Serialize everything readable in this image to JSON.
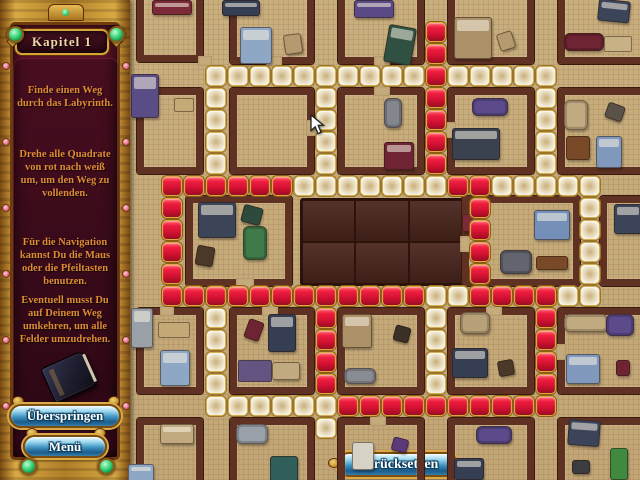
{
  "window": {
    "width": 640,
    "height": 480
  },
  "sidebar": {
    "title": "Kapitel 1",
    "paragraphs": [
      "Finde einen Weg durch das Labyrinth.",
      "Drehe alle Quadrate von rot nach weiß um, um den Weg zu vollenden.",
      "Für die Navigation kannst Du die Maus oder die Pfeiltasten benutzen.",
      "Eventuell musst Du auf Deinem Weg umkehren, um alle Felder umzudrehen."
    ],
    "book_icon": "journal-book-icon",
    "skip_button": "Überspringen",
    "menu_button": "Menü"
  },
  "board": {
    "reset_button": "Zurücksetzen",
    "marker": {
      "col": 12,
      "row": 13,
      "color": "#f7a31a"
    },
    "cursor": {
      "x": 310,
      "y": 114
    }
  },
  "puzzle": {
    "grid": {
      "origin_x": 140,
      "origin_y": 0,
      "pitch": 22,
      "tile_size": 20
    },
    "colors": {
      "red": "#d31132",
      "white": "#f1ead6",
      "gold_border": "#d2a743"
    },
    "red_tiles": [
      [
        13,
        1
      ],
      [
        13,
        2
      ],
      [
        13,
        3
      ],
      [
        13,
        4
      ],
      [
        13,
        5
      ],
      [
        13,
        6
      ],
      [
        13,
        7
      ],
      [
        1,
        8
      ],
      [
        2,
        8
      ],
      [
        3,
        8
      ],
      [
        4,
        8
      ],
      [
        5,
        8
      ],
      [
        6,
        8
      ],
      [
        14,
        8
      ],
      [
        15,
        8
      ],
      [
        1,
        9
      ],
      [
        1,
        10
      ],
      [
        1,
        11
      ],
      [
        1,
        12
      ],
      [
        15,
        9
      ],
      [
        15,
        10
      ],
      [
        15,
        11
      ],
      [
        15,
        12
      ],
      [
        1,
        13
      ],
      [
        2,
        13
      ],
      [
        3,
        13
      ],
      [
        4,
        13
      ],
      [
        5,
        13
      ],
      [
        6,
        13
      ],
      [
        7,
        13
      ],
      [
        8,
        13
      ],
      [
        9,
        13
      ],
      [
        10,
        13
      ],
      [
        11,
        13
      ],
      [
        12,
        13
      ],
      [
        15,
        13
      ],
      [
        16,
        13
      ],
      [
        17,
        13
      ],
      [
        18,
        13
      ],
      [
        8,
        14
      ],
      [
        8,
        15
      ],
      [
        8,
        16
      ],
      [
        8,
        17
      ],
      [
        18,
        14
      ],
      [
        18,
        15
      ],
      [
        18,
        16
      ],
      [
        18,
        17
      ],
      [
        9,
        18
      ],
      [
        10,
        18
      ],
      [
        11,
        18
      ],
      [
        12,
        18
      ],
      [
        13,
        18
      ],
      [
        14,
        18
      ],
      [
        15,
        18
      ],
      [
        16,
        18
      ],
      [
        17,
        18
      ],
      [
        18,
        18
      ]
    ],
    "white_tiles": [
      [
        3,
        3
      ],
      [
        4,
        3
      ],
      [
        5,
        3
      ],
      [
        6,
        3
      ],
      [
        7,
        3
      ],
      [
        8,
        3
      ],
      [
        9,
        3
      ],
      [
        10,
        3
      ],
      [
        11,
        3
      ],
      [
        12,
        3
      ],
      [
        14,
        3
      ],
      [
        15,
        3
      ],
      [
        16,
        3
      ],
      [
        17,
        3
      ],
      [
        18,
        3
      ],
      [
        3,
        4
      ],
      [
        3,
        5
      ],
      [
        3,
        6
      ],
      [
        3,
        7
      ],
      [
        8,
        4
      ],
      [
        8,
        5
      ],
      [
        8,
        6
      ],
      [
        8,
        7
      ],
      [
        18,
        4
      ],
      [
        18,
        5
      ],
      [
        18,
        6
      ],
      [
        18,
        7
      ],
      [
        7,
        8
      ],
      [
        8,
        8
      ],
      [
        9,
        8
      ],
      [
        10,
        8
      ],
      [
        11,
        8
      ],
      [
        12,
        8
      ],
      [
        13,
        8
      ],
      [
        16,
        8
      ],
      [
        17,
        8
      ],
      [
        18,
        8
      ],
      [
        19,
        8
      ],
      [
        20,
        8
      ],
      [
        20,
        9
      ],
      [
        20,
        10
      ],
      [
        20,
        11
      ],
      [
        20,
        12
      ],
      [
        13,
        13
      ],
      [
        14,
        13
      ],
      [
        19,
        13
      ],
      [
        20,
        13
      ],
      [
        3,
        14
      ],
      [
        3,
        15
      ],
      [
        3,
        16
      ],
      [
        3,
        17
      ],
      [
        13,
        14
      ],
      [
        13,
        15
      ],
      [
        13,
        16
      ],
      [
        13,
        17
      ],
      [
        3,
        18
      ],
      [
        4,
        18
      ],
      [
        5,
        18
      ],
      [
        6,
        18
      ],
      [
        7,
        18
      ],
      [
        8,
        18
      ],
      [
        8,
        19
      ]
    ]
  },
  "map": {
    "floor_color": "#c5ab7b",
    "wall_color": "#5e3123",
    "center_building": {
      "x": 300,
      "y": 198,
      "w": 160,
      "h": 84,
      "color": "#46231a"
    },
    "rooms": [
      [
        137,
        -10,
        66,
        72
      ],
      [
        230,
        -10,
        84,
        74
      ],
      [
        338,
        -10,
        86,
        74
      ],
      [
        448,
        -10,
        86,
        74
      ],
      [
        558,
        -10,
        96,
        74
      ],
      [
        137,
        88,
        66,
        86
      ],
      [
        230,
        88,
        84,
        86
      ],
      [
        338,
        88,
        86,
        86
      ],
      [
        448,
        88,
        86,
        86
      ],
      [
        558,
        88,
        96,
        86
      ],
      [
        186,
        196,
        106,
        90
      ],
      [
        462,
        196,
        118,
        90
      ],
      [
        600,
        196,
        54,
        90
      ],
      [
        137,
        308,
        66,
        86
      ],
      [
        230,
        308,
        84,
        86
      ],
      [
        338,
        308,
        86,
        86
      ],
      [
        448,
        308,
        86,
        86
      ],
      [
        558,
        308,
        96,
        86
      ],
      [
        137,
        418,
        66,
        70
      ],
      [
        230,
        418,
        84,
        70
      ],
      [
        338,
        418,
        86,
        70
      ],
      [
        448,
        418,
        86,
        70
      ],
      [
        558,
        418,
        96,
        70
      ]
    ],
    "doors": [
      [
        266,
        56,
        16,
        10
      ],
      [
        374,
        56,
        16,
        10
      ],
      [
        374,
        86,
        16,
        10
      ],
      [
        306,
        120,
        10,
        16
      ],
      [
        446,
        122,
        10,
        16
      ],
      [
        236,
        278,
        18,
        10
      ],
      [
        460,
        236,
        10,
        16
      ],
      [
        262,
        306,
        16,
        10
      ],
      [
        486,
        306,
        16,
        10
      ],
      [
        370,
        416,
        16,
        10
      ],
      [
        556,
        344,
        10,
        16
      ],
      [
        198,
        56,
        14,
        10
      ],
      [
        160,
        306,
        14,
        10
      ]
    ],
    "furniture": [
      {
        "t": "bed",
        "x": 152,
        "y": 0,
        "w": 38,
        "h": 13,
        "c": "#7c2a38",
        "r": 0
      },
      {
        "t": "bed",
        "x": 222,
        "y": 0,
        "w": 36,
        "h": 14,
        "c": "#363e54",
        "r": 0
      },
      {
        "t": "bed",
        "x": 354,
        "y": 0,
        "w": 38,
        "h": 16,
        "c": "#5b4a86",
        "r": 0
      },
      {
        "t": "bed",
        "x": 598,
        "y": 0,
        "w": 30,
        "h": 20,
        "c": "#3c445a",
        "r": 6
      },
      {
        "t": "bed",
        "x": 240,
        "y": 27,
        "w": 30,
        "h": 35,
        "c": "#8ea7c4",
        "r": 0
      },
      {
        "t": "chair",
        "x": 284,
        "y": 34,
        "w": 16,
        "h": 18,
        "c": "#b49a6e",
        "r": -8
      },
      {
        "t": "bed",
        "x": 386,
        "y": 26,
        "w": 26,
        "h": 36,
        "c": "#305042",
        "r": 10
      },
      {
        "t": "bed",
        "x": 454,
        "y": 17,
        "w": 36,
        "h": 40,
        "c": "#ab9068",
        "r": 0
      },
      {
        "t": "chair",
        "x": 498,
        "y": 32,
        "w": 14,
        "h": 16,
        "c": "#b49a6e",
        "r": -18
      },
      {
        "t": "couch",
        "x": 564,
        "y": 33,
        "w": 38,
        "h": 16,
        "c": "#6e2433",
        "r": 0
      },
      {
        "t": "rug",
        "x": 604,
        "y": 36,
        "w": 26,
        "h": 14,
        "c": "#c9b285",
        "r": 0
      },
      {
        "t": "bed",
        "x": 131,
        "y": 74,
        "w": 26,
        "h": 42,
        "c": "#5a4c84",
        "r": 0
      },
      {
        "t": "rug",
        "x": 174,
        "y": 98,
        "w": 18,
        "h": 12,
        "c": "#c4aa76",
        "r": 0
      },
      {
        "t": "couch",
        "x": 384,
        "y": 98,
        "w": 16,
        "h": 28,
        "c": "#84868e",
        "r": 0
      },
      {
        "t": "bed",
        "x": 384,
        "y": 142,
        "w": 28,
        "h": 26,
        "c": "#6e2433",
        "r": 0
      },
      {
        "t": "couch",
        "x": 472,
        "y": 98,
        "w": 34,
        "h": 16,
        "c": "#5c4a8a",
        "r": 0
      },
      {
        "t": "bed",
        "x": 452,
        "y": 128,
        "w": 46,
        "h": 30,
        "c": "#3a4250",
        "r": 0
      },
      {
        "t": "couch",
        "x": 564,
        "y": 100,
        "w": 22,
        "h": 28,
        "c": "#c2aa80",
        "r": 0
      },
      {
        "t": "item",
        "x": 606,
        "y": 104,
        "w": 16,
        "h": 14,
        "c": "#5a5248",
        "r": 20
      },
      {
        "t": "table",
        "x": 566,
        "y": 136,
        "w": 22,
        "h": 22,
        "c": "#7a4a28",
        "r": 0
      },
      {
        "t": "bed",
        "x": 596,
        "y": 136,
        "w": 24,
        "h": 30,
        "c": "#8098bc",
        "r": 0
      },
      {
        "t": "bed",
        "x": 198,
        "y": 202,
        "w": 36,
        "h": 34,
        "c": "#3c4458",
        "r": 0
      },
      {
        "t": "item",
        "x": 242,
        "y": 206,
        "w": 18,
        "h": 16,
        "c": "#2e4a3c",
        "r": 15
      },
      {
        "t": "couch",
        "x": 243,
        "y": 226,
        "w": 22,
        "h": 32,
        "c": "#3f7a4a",
        "r": 0
      },
      {
        "t": "chair",
        "x": 196,
        "y": 246,
        "w": 16,
        "h": 18,
        "c": "#4a3828",
        "r": 10
      },
      {
        "t": "chair",
        "x": 462,
        "y": 214,
        "w": 14,
        "h": 16,
        "c": "#7c2a38",
        "r": 0
      },
      {
        "t": "bed",
        "x": 534,
        "y": 210,
        "w": 34,
        "h": 28,
        "c": "#7490b8",
        "r": 0
      },
      {
        "t": "couch",
        "x": 500,
        "y": 250,
        "w": 30,
        "h": 22,
        "c": "#62646e",
        "r": 0
      },
      {
        "t": "table",
        "x": 536,
        "y": 256,
        "w": 30,
        "h": 12,
        "c": "#7a4a28",
        "r": 0
      },
      {
        "t": "bed",
        "x": 614,
        "y": 204,
        "w": 26,
        "h": 28,
        "c": "#3c445a",
        "r": 0
      },
      {
        "t": "bed",
        "x": 131,
        "y": 308,
        "w": 20,
        "h": 38,
        "c": "#9aa0a8",
        "r": 0
      },
      {
        "t": "rug",
        "x": 158,
        "y": 322,
        "w": 30,
        "h": 14,
        "c": "#c4aa76",
        "r": 0
      },
      {
        "t": "bed",
        "x": 160,
        "y": 350,
        "w": 28,
        "h": 34,
        "c": "#8ea7c4",
        "r": 0
      },
      {
        "t": "book",
        "x": 246,
        "y": 320,
        "w": 14,
        "h": 18,
        "c": "#6e2433",
        "r": 20
      },
      {
        "t": "bed",
        "x": 268,
        "y": 314,
        "w": 26,
        "h": 36,
        "c": "#363e54",
        "r": 0
      },
      {
        "t": "rug",
        "x": 238,
        "y": 360,
        "w": 32,
        "h": 20,
        "c": "#5a4c84",
        "r": 0
      },
      {
        "t": "chair",
        "x": 272,
        "y": 362,
        "w": 26,
        "h": 16,
        "c": "#c2aa80",
        "r": 0
      },
      {
        "t": "bed",
        "x": 342,
        "y": 314,
        "w": 28,
        "h": 32,
        "c": "#ab9068",
        "r": 0
      },
      {
        "t": "couch",
        "x": 344,
        "y": 368,
        "w": 30,
        "h": 14,
        "c": "#8a8c94",
        "r": 0
      },
      {
        "t": "couch",
        "x": 460,
        "y": 312,
        "w": 28,
        "h": 20,
        "c": "#b8a078",
        "r": 0
      },
      {
        "t": "book",
        "x": 394,
        "y": 326,
        "w": 14,
        "h": 14,
        "c": "#3a3026",
        "r": 15
      },
      {
        "t": "bed",
        "x": 452,
        "y": 348,
        "w": 34,
        "h": 28,
        "c": "#363e54",
        "r": 0
      },
      {
        "t": "book",
        "x": 498,
        "y": 360,
        "w": 14,
        "h": 14,
        "c": "#4a3828",
        "r": -10
      },
      {
        "t": "couch",
        "x": 564,
        "y": 314,
        "w": 42,
        "h": 16,
        "c": "#c2aa80",
        "r": 0
      },
      {
        "t": "couch",
        "x": 606,
        "y": 314,
        "w": 26,
        "h": 20,
        "c": "#5c4a8a",
        "r": 0
      },
      {
        "t": "bed",
        "x": 566,
        "y": 354,
        "w": 32,
        "h": 28,
        "c": "#8098bc",
        "r": 0
      },
      {
        "t": "item",
        "x": 616,
        "y": 360,
        "w": 12,
        "h": 14,
        "c": "#6e2433",
        "r": 0
      },
      {
        "t": "bed",
        "x": 160,
        "y": 424,
        "w": 32,
        "h": 18,
        "c": "#c2aa80",
        "r": 0
      },
      {
        "t": "couch",
        "x": 236,
        "y": 424,
        "w": 30,
        "h": 18,
        "c": "#9aa0a8",
        "r": 0
      },
      {
        "t": "bed",
        "x": 128,
        "y": 464,
        "w": 24,
        "h": 16,
        "c": "#8ea7c4",
        "r": 0
      },
      {
        "t": "item",
        "x": 270,
        "y": 456,
        "w": 26,
        "h": 24,
        "c": "#2f5f58",
        "r": 0
      },
      {
        "t": "item",
        "x": 352,
        "y": 442,
        "w": 20,
        "h": 26,
        "c": "#d6d2c6",
        "r": 0
      },
      {
        "t": "book",
        "x": 392,
        "y": 438,
        "w": 14,
        "h": 12,
        "c": "#5c3a7a",
        "r": 15
      },
      {
        "t": "couch",
        "x": 476,
        "y": 426,
        "w": 34,
        "h": 16,
        "c": "#5c4a8a",
        "r": 0
      },
      {
        "t": "bed",
        "x": 454,
        "y": 458,
        "w": 28,
        "h": 20,
        "c": "#363e54",
        "r": 0
      },
      {
        "t": "bed",
        "x": 568,
        "y": 420,
        "w": 30,
        "h": 24,
        "c": "#3c445a",
        "r": 4
      },
      {
        "t": "item",
        "x": 572,
        "y": 460,
        "w": 16,
        "h": 12,
        "c": "#3a3c40",
        "r": 0
      },
      {
        "t": "door",
        "x": 610,
        "y": 448,
        "w": 16,
        "h": 30,
        "c": "#3f8a3f",
        "r": 0
      }
    ]
  }
}
